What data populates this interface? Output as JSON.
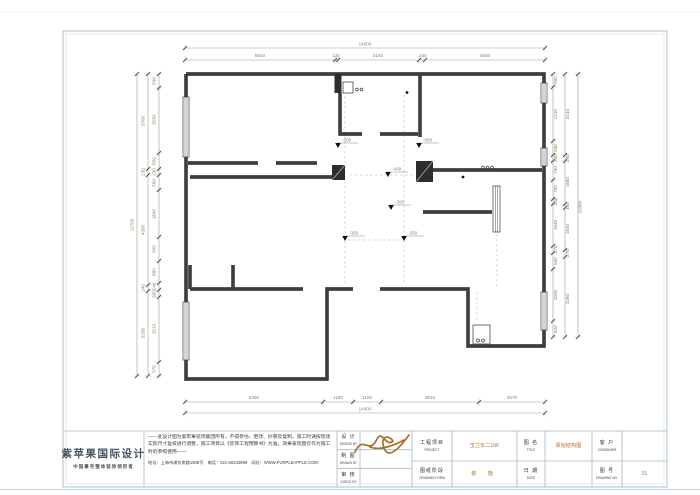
{
  "tb": {
    "logo_name": "紫苹果国际设计",
    "logo_tagline": "中国豪宅整体装饰领衔者",
    "disclaimer": "——此设计图为紫苹果装饰集团所有，不得参仿、更改、抄袭及复制，施工时请按现场实际尺寸复核进行调整，施工项目以《装饰工程预算书》为准，效果表现图仅作为施工时的参照使用——",
    "address": "地址：上海市浦东南路1508号　电话：021-60333999　网址：WWW.PURPLEAPPLE.COM",
    "roles": [
      {
        "cn": "设 计",
        "en": "DESING BY"
      },
      {
        "cn": "制 图",
        "en": "DRAWN BY"
      },
      {
        "cn": "审 核",
        "en": "CHECK BY"
      }
    ],
    "project": {
      "cn": "工程项目",
      "en": "PROJECT",
      "value": "玉兰东二16F"
    },
    "gtitle": {
      "cn": "图 名",
      "en": "TITLE",
      "value": "原始结构图"
    },
    "consumer": {
      "cn": "客 户",
      "en": "CONSUMER",
      "value": ""
    },
    "stage": {
      "cn": "图纸阶段",
      "en": "DRAWING FORM",
      "value": "装 施"
    },
    "date": {
      "cn": "日 期",
      "en": "DATE",
      "value": ""
    },
    "dno": {
      "cn": "图 号",
      "en": "DRAWING NO.",
      "value": "01"
    }
  },
  "plan": {
    "dims": [
      [
        365,
        45.5,
        0,
        "14000"
      ],
      [
        260,
        57,
        0,
        "5840"
      ],
      [
        336,
        57,
        0,
        "120"
      ],
      [
        378,
        57,
        0,
        "3150"
      ],
      [
        423,
        57,
        0,
        "240"
      ],
      [
        485,
        57,
        0,
        "4650"
      ],
      [
        254,
        399,
        0,
        "5360"
      ],
      [
        338,
        399,
        0,
        "1160"
      ],
      [
        367,
        399,
        0,
        "1100"
      ],
      [
        430,
        399,
        0,
        "3810"
      ],
      [
        512,
        399,
        0,
        "2570"
      ],
      [
        365,
        410.5,
        0,
        "14000"
      ],
      [
        133.5,
        225,
        -90,
        "11750"
      ],
      [
        144.5,
        121,
        -90,
        "3700"
      ],
      [
        144.5,
        172,
        -90,
        "230"
      ],
      [
        144.5,
        230,
        -90,
        "4300"
      ],
      [
        144.5,
        288,
        -90,
        "240"
      ],
      [
        144.5,
        333,
        -90,
        "3280"
      ],
      [
        155.5,
        81,
        -90,
        "530"
      ],
      [
        155.5,
        120,
        -90,
        "2530"
      ],
      [
        155.5,
        161,
        -90,
        "650"
      ],
      [
        155.5,
        172,
        -90,
        "230"
      ],
      [
        155.5,
        183,
        -90,
        "580"
      ],
      [
        155.5,
        214,
        -90,
        "1840"
      ],
      [
        155.5,
        249,
        -90,
        "900"
      ],
      [
        155.5,
        272,
        -90,
        "880"
      ],
      [
        155.5,
        286.5,
        -90,
        "240"
      ],
      [
        155.5,
        294,
        -90,
        "300"
      ],
      [
        155.5,
        329,
        -90,
        "2510"
      ],
      [
        155.5,
        369,
        -90,
        "570"
      ],
      [
        557,
        80,
        -90,
        "500"
      ],
      [
        557,
        114,
        -90,
        "2110"
      ],
      [
        557,
        148,
        -90,
        "530"
      ],
      [
        557,
        158,
        -90,
        "240"
      ],
      [
        557,
        170,
        -90,
        "730"
      ],
      [
        557,
        189,
        -90,
        "750"
      ],
      [
        557,
        201.5,
        -90,
        "180"
      ],
      [
        557,
        225,
        -90,
        "1640"
      ],
      [
        557,
        249.5,
        -90,
        "270"
      ],
      [
        557,
        261,
        -90,
        "640"
      ],
      [
        557,
        295,
        -90,
        "2000"
      ],
      [
        557,
        329,
        -90,
        "620"
      ],
      [
        569,
        114,
        -90,
        "3140"
      ],
      [
        569,
        158,
        -90,
        "240"
      ],
      [
        569,
        182,
        -90,
        "1680"
      ],
      [
        569,
        206,
        -90,
        "150"
      ],
      [
        569,
        229,
        -90,
        "1640"
      ],
      [
        569,
        253,
        -90,
        "270"
      ],
      [
        569,
        299,
        -90,
        "3260"
      ],
      [
        581.5,
        207,
        -90,
        "10360"
      ]
    ],
    "levels": [
      [
        338,
        147,
        "-300"
      ],
      [
        419,
        147,
        "-350"
      ],
      [
        388,
        176,
        "-400"
      ],
      [
        391,
        209,
        "-350"
      ],
      [
        345,
        240,
        "-350"
      ],
      [
        404,
        240,
        "-350"
      ]
    ]
  }
}
